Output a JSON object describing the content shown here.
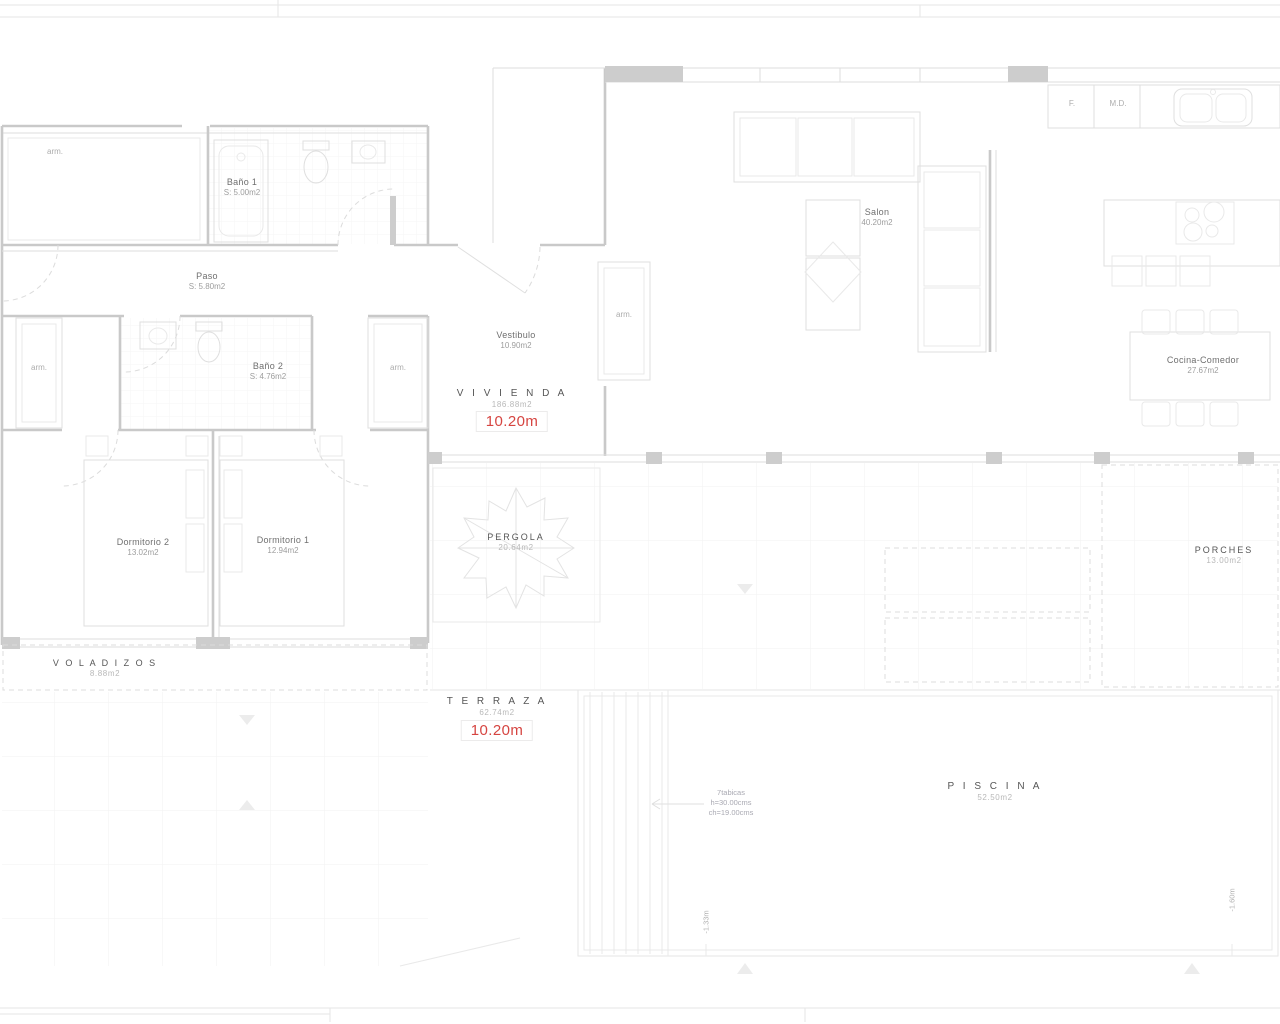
{
  "rooms": {
    "bano1": {
      "name": "Baño 1",
      "area": "S: 5.00m2"
    },
    "paso": {
      "name": "Paso",
      "area": "S: 5.80m2"
    },
    "bano2": {
      "name": "Baño 2",
      "area": "S: 4.76m2"
    },
    "vestibulo": {
      "name": "Vestibulo",
      "area": "10.90m2"
    },
    "salon": {
      "name": "Salon",
      "area": "40.20m2"
    },
    "cocina": {
      "name": "Cocina-Comedor",
      "area": "27.67m2"
    },
    "dorm2": {
      "name": "Dormitorio 2",
      "area": "13.02m2"
    },
    "dorm1": {
      "name": "Dormitorio 1",
      "area": "12.94m2"
    }
  },
  "zones": {
    "vivienda": {
      "name": "V I V I E N D A",
      "area": "186.88m2"
    },
    "voladizos": {
      "name": "V O L A D I Z O S",
      "area": "8.88m2"
    },
    "pergola": {
      "name": "PERGOLA",
      "area": "20.64m2"
    },
    "porches": {
      "name": "PORCHES",
      "area": "13.00m2"
    },
    "terraza": {
      "name": "T E R R A Z A",
      "area": "62.74m2"
    },
    "piscina": {
      "name": "P I S C I N A",
      "area": "52.50m2"
    }
  },
  "labels": {
    "closet": "arm.",
    "dim": "10.20m",
    "kitchen_f": "F.",
    "kitchen_md": "M.D.",
    "stairs": {
      "l1": "7tabicas",
      "l2": "h=30.00cms",
      "l3": "ch=19.00cms"
    },
    "depth_left": "-1.33m",
    "depth_right": "-1.60m"
  },
  "colors": {
    "accent_red": "#d64541",
    "wall": "#c9c9c9",
    "furniture": "#dfdfdf",
    "text": "#6f6f6f"
  }
}
